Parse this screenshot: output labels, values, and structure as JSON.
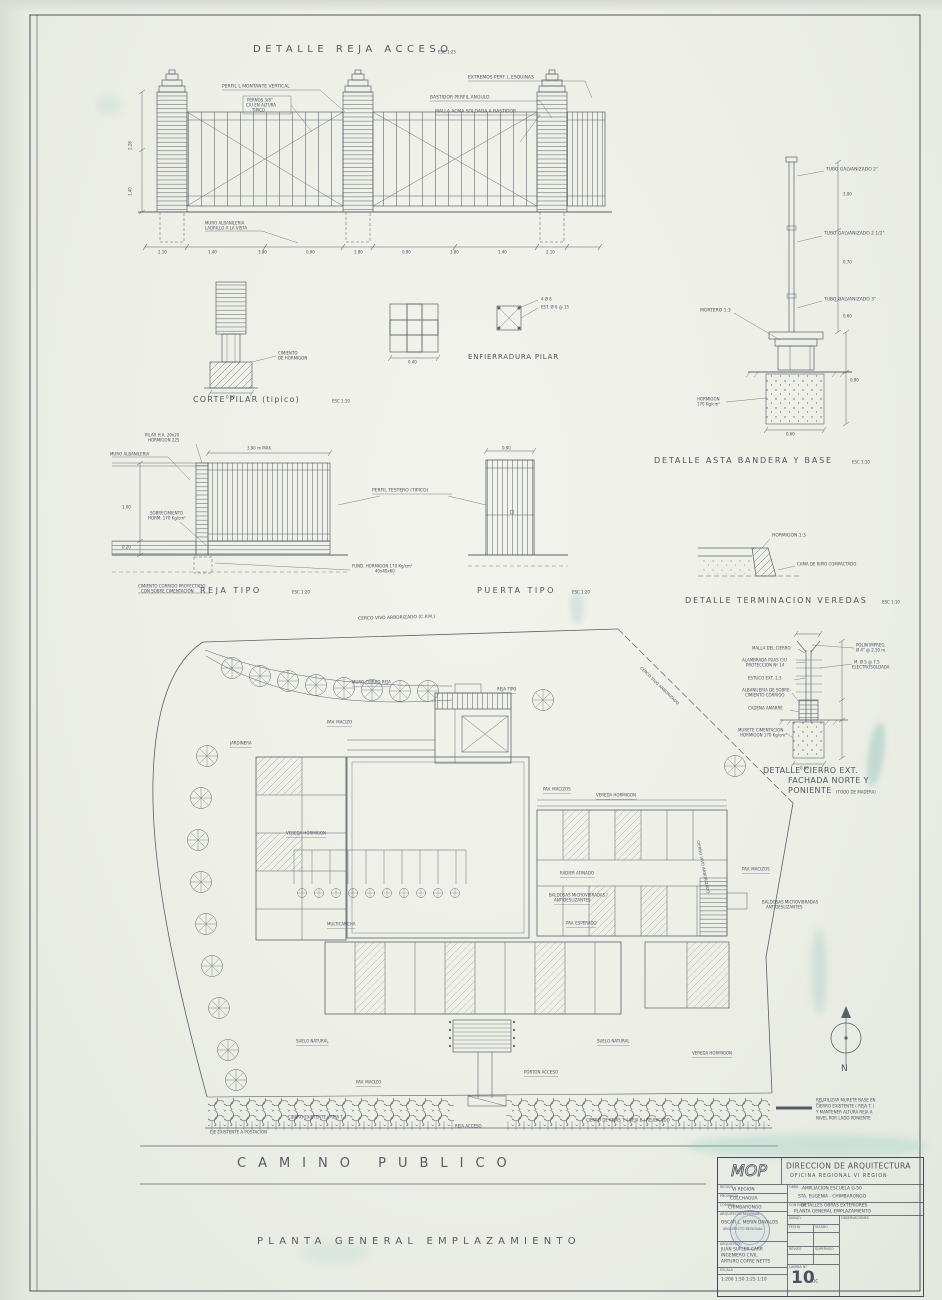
{
  "colors": {
    "paper": "#eef0e8",
    "ink": "#4a5160",
    "stain": "#9fc9bf"
  },
  "header": {
    "main_title": "DETALLE REJA ACCESO",
    "main_scale": "ESC 1:25"
  },
  "fence": {
    "perfil_montante": "PERFIL L MONTANTE VERTICAL",
    "pernos_1": "PERNOS 3/8\"",
    "pernos_2": "C/U EN ALTURA",
    "pernos_3": "TIPICO",
    "extremos": "EXTREMOS PERF. L ESQUINAS",
    "bastidor": "BASTIDOR PERFIL ANGULO",
    "malla": "MALLA ACMA SOLDADA A BASTIDOR",
    "muro_1": "MURO ALBAÑILERIA",
    "muro_2": "LADRILLO A LA VISTA",
    "dims_bottom": [
      "2.10",
      "1.40",
      "3.80",
      "0.90",
      "3.80",
      "0.90",
      "3.80",
      "1.40",
      "2.10"
    ],
    "dim_left_1": "2.28",
    "dim_left_2": "1.40"
  },
  "flag": {
    "title": "DETALLE ASTA BANDERA Y BASE",
    "scale": "ESC 1:10",
    "tubo_top": "TUBO GALVANIZADO 2\"",
    "tubo_mid": "TUBO GALVANIZADO 2 1/2\"",
    "tubo_low": "TUBO GALVANIZADO 3\"",
    "mortero": "MORTERO 1:3",
    "hormigon_1": "HORMIGON",
    "hormigon_2": "170 Kg/cm²",
    "dim_1": "3.00",
    "dim_2": "0.70",
    "dim_3": "0.60",
    "dim_4": "0.90",
    "dim_5": "0.60"
  },
  "pilar": {
    "title": "CORTE PILAR (tipico)",
    "scale": "ESC 1:10",
    "dim": "0.50",
    "cimiento_1": "CIMIENTO",
    "cimiento_2": "DE HORMIGON",
    "plan_dim": "0.40",
    "enf_title": "ENFIERRADURA PILAR",
    "fe_1": "4 Ø 8",
    "fe_2": "EST. Ø 6 @ 15"
  },
  "reja": {
    "caption": "REJA TIPO",
    "scale": "ESC 1:20",
    "pilar_1": "PILAR H.A. 20x20",
    "pilar_2": "HORMIGON 225",
    "muro": "MURO ALBAÑILERIA",
    "dim_top": "3.90 m MAX.",
    "sobrecimiento_1": "SOBRECIMIENTO",
    "sobrecimiento_2": "HORM. 170 Kg/cm²",
    "perfil": "PERFIL TESTERO (TIPICO)",
    "fundacion_1": "FUND. HORMIGON 170 Kg/cm²",
    "fundacion_2": "40x40x60",
    "nota_1": "CIMIENTO CORRIDO PROYECTADO",
    "nota_2": "CON SOBRE CIMENTACION",
    "dim_izq_1": "1.00",
    "dim_izq_2": "0.20"
  },
  "puerta": {
    "caption": "PUERTA TIPO",
    "scale": "ESC 1:20",
    "dim": "0.90"
  },
  "veredas": {
    "title": "DETALLE TERMINACION VEREDAS",
    "scale": "ESC 1:10",
    "hormigon": "HORMIGON 1:3",
    "cama": "CAMA DE RIPIO COMPACTADO"
  },
  "cierro": {
    "title_1": "DETALLE CIERRO EXT.",
    "title_2": "FACHADA NORTE Y",
    "title_3": "PONIENTE",
    "title_note": "(TODO DE MADERA)",
    "malla": "MALLA DEL CIERRO",
    "alambre_1": "ALAMBRADA PUAS C/U",
    "alambre_2": "PROTECCION Nº 14",
    "estuco": "ESTUCO EXT. 1:3",
    "albanileria_1": "ALBAÑILERIA DE SOBRE-",
    "albanileria_2": "CIMIENTO CORRIDO",
    "cadena": "CADENA AMARRE",
    "murete_1": "MURETE CIMENTACION",
    "murete_2": "HORMIGON 170 Kg/cm²",
    "polin_1": "POLIN IMPREG.",
    "polin_2": "Ø 4\" @ 2.50 m",
    "malla_e_1": "M. Ø 5 @ 7.5",
    "malla_e_2": "ELECTROSOLDADA",
    "dim_base": "0.60"
  },
  "plan": {
    "cerco_top": "CERCO VIVO ARBORIZADO (C.P.M.)",
    "muro_cierro": "MURO CIERRO REJA",
    "reja_tipo": "REJA TIPO",
    "pav_macizo_1": "PAV. MACIZO",
    "jardinera": "JARDINERA",
    "pav_macizos_2": "PAV. MACIZOS",
    "vereda_1": "VEREDA HORMIGON",
    "vereda_2": "VEREDA HORMIGON",
    "radier": "RADIER AFINADO",
    "baldosas_1a": "BALDOSAS MICROVIBRADAS /",
    "baldosas_1b": "ANTIDESLIZANTES",
    "pav_esperado": "PAV. ESPERADO",
    "multicancha": "MULTICANCHA",
    "pav_macizos_3": "PAV. MACIZOS",
    "baldosas_2a": "BALDOSAS MICROVIBRADAS",
    "baldosas_2b": "ANTIDESLIZANTES",
    "cierro_diag": "CIERRO VIVO ARBORIZADO",
    "cerco_ne": "CERCO VIVO ARBORIZADO",
    "suelo_1": "SUELO NATURAL",
    "suelo_2": "SUELO NATURAL",
    "vereda_3": "VEREDA HORMIGON",
    "porton": "PORTON ACCESO",
    "pav_macizo_4": "PAV. MACIZO",
    "cierro_izq": "CIERRO EXISTENTE ( REJA T. )",
    "cierro_der": "CIERRO DE REJAS T. ( REJA 2 ) REUBICADO",
    "eje": "EJE EXISTENTE A POSTACION",
    "reja_acceso": "REJA ACCESO"
  },
  "footer": {
    "camino": "CAMINO PUBLICO",
    "planta": "PLANTA GENERAL EMPLAZAMIENTO",
    "north": "N",
    "legend": [
      "REUTILIZAR MURETE BASE EN",
      "CIERRO EXISTENTE ( REJA T. )",
      "Y MANTENER ALTURA REJA A",
      "NIVEL POR LADO PONIENTE"
    ]
  },
  "titleblock": {
    "logo": "MOP",
    "org_1": "DIRECCION DE ARQUITECTURA",
    "org_2": "OFICINA REGIONAL VI REGION",
    "region_label": "REGION",
    "region": "VI REGION",
    "provincia_label": "PROVINCIA",
    "provincia": "COLCHAGUA",
    "comuna_label": "COMUNA",
    "comuna": "CHIMBARONGO",
    "arq_label": "ARQUITECTO REGIONAL",
    "arq_nombre": "OSCAR L. MERIN DAVALOS",
    "arq_cargo": "ARQUITECTO REGIONAL",
    "prof_label": "ARQUITECTO",
    "prof_1": "JUAN SUFLER CARR",
    "prof_2": "INGENIERO CIVIL",
    "prof_3": "ARTURO COFRE NETTS",
    "escala_label": "ESCALA",
    "escala": "1:200 1:50 1:25 1:10",
    "obra_label": "OBRA",
    "obra_1": "AMPLIACION ESCUELA G-50",
    "obra_2": "STA. EUGENIA - CHIMBARONGO",
    "contenido_label": "CONTIENE",
    "contenido_1": "DETALLES OBRAS EXTERIORES",
    "contenido_2": "PLANTA GENERAL EMPLAZAMIENTO",
    "dibujo_label": "DIBUJO",
    "observaciones_label": "OBSERVACIONES",
    "fecha_label": "FECHA",
    "visado_label": "VISADO",
    "reviso_label": "REVISO",
    "superviso_label": "SUPERVISO",
    "lamina_label": "LAMINA Nº",
    "lamina": "10",
    "lamina_suffix": "OC"
  }
}
